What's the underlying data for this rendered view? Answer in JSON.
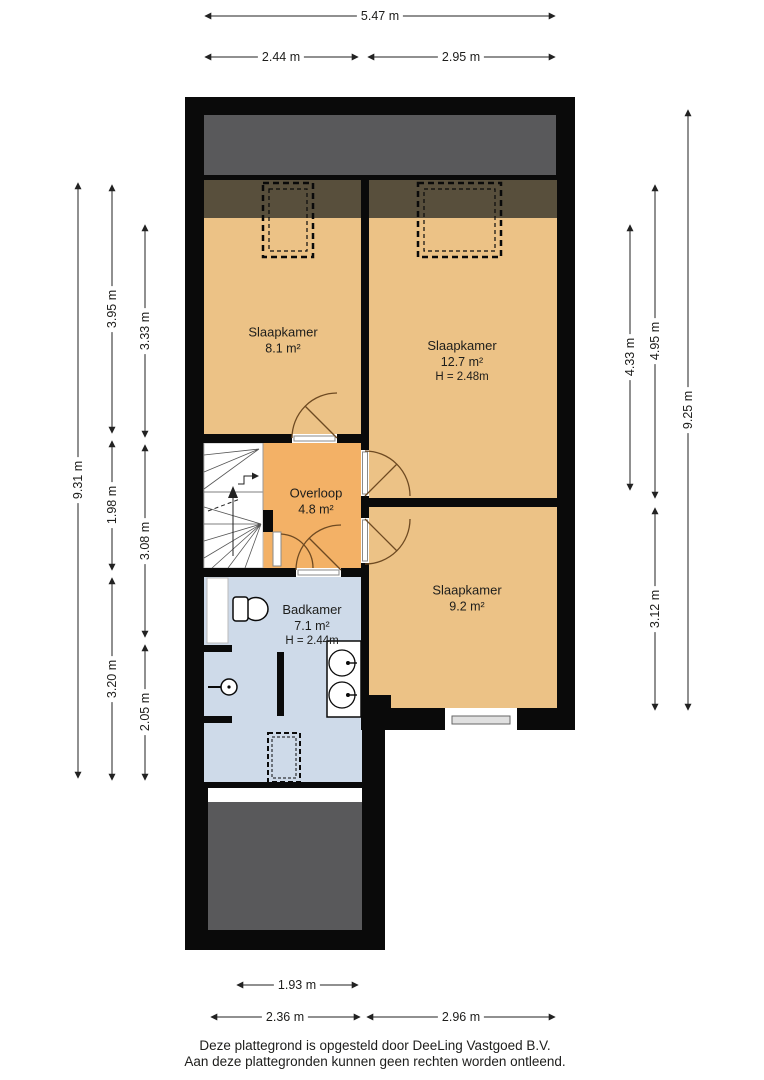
{
  "plan": {
    "title": "floor-plan",
    "rooms": [
      {
        "name": "Slaapkamer",
        "area": "8.1 m²",
        "height": ""
      },
      {
        "name": "Slaapkamer",
        "area": "12.7 m²",
        "height": "H = 2.48m"
      },
      {
        "name": "Overloop",
        "area": "4.8 m²",
        "height": ""
      },
      {
        "name": "Slaapkamer",
        "area": "9.2 m²",
        "height": ""
      },
      {
        "name": "Badkamer",
        "area": "7.1 m²",
        "height": "H = 2.44m"
      }
    ]
  },
  "dimensions": {
    "top_total": "5.47 m",
    "top_left": "2.44 m",
    "top_right": "2.95 m",
    "left_total": "9.31 m",
    "left_mid": [
      "3.95 m",
      "1.98 m",
      "3.20 m"
    ],
    "left_inner": [
      "3.33 m",
      "3.08 m",
      "2.05 m"
    ],
    "right_total": "9.25 m",
    "right_mid": [
      "4.95 m",
      "3.12 m"
    ],
    "right_inner": [
      "4.33 m"
    ],
    "bottom_inner": "1.93 m",
    "bottom_left": "2.36 m",
    "bottom_right": "2.96 m"
  },
  "footer": {
    "line1": "Deze plattegrond is opgesteld door DeeLing Vastgoed B.V.",
    "line2": "Aan deze plattegronden kunnen geen rechten worden ontleend."
  },
  "colors": {
    "wall": "#0a0a0a",
    "bedroom_floor": "#ECC286",
    "overloop_floor": "#F3B166",
    "bathroom_floor": "#CEDAE9",
    "roof": "#59595B",
    "under_roof": "#584F3C",
    "door_arc": "#6E4A22",
    "dimension": "#222222"
  }
}
